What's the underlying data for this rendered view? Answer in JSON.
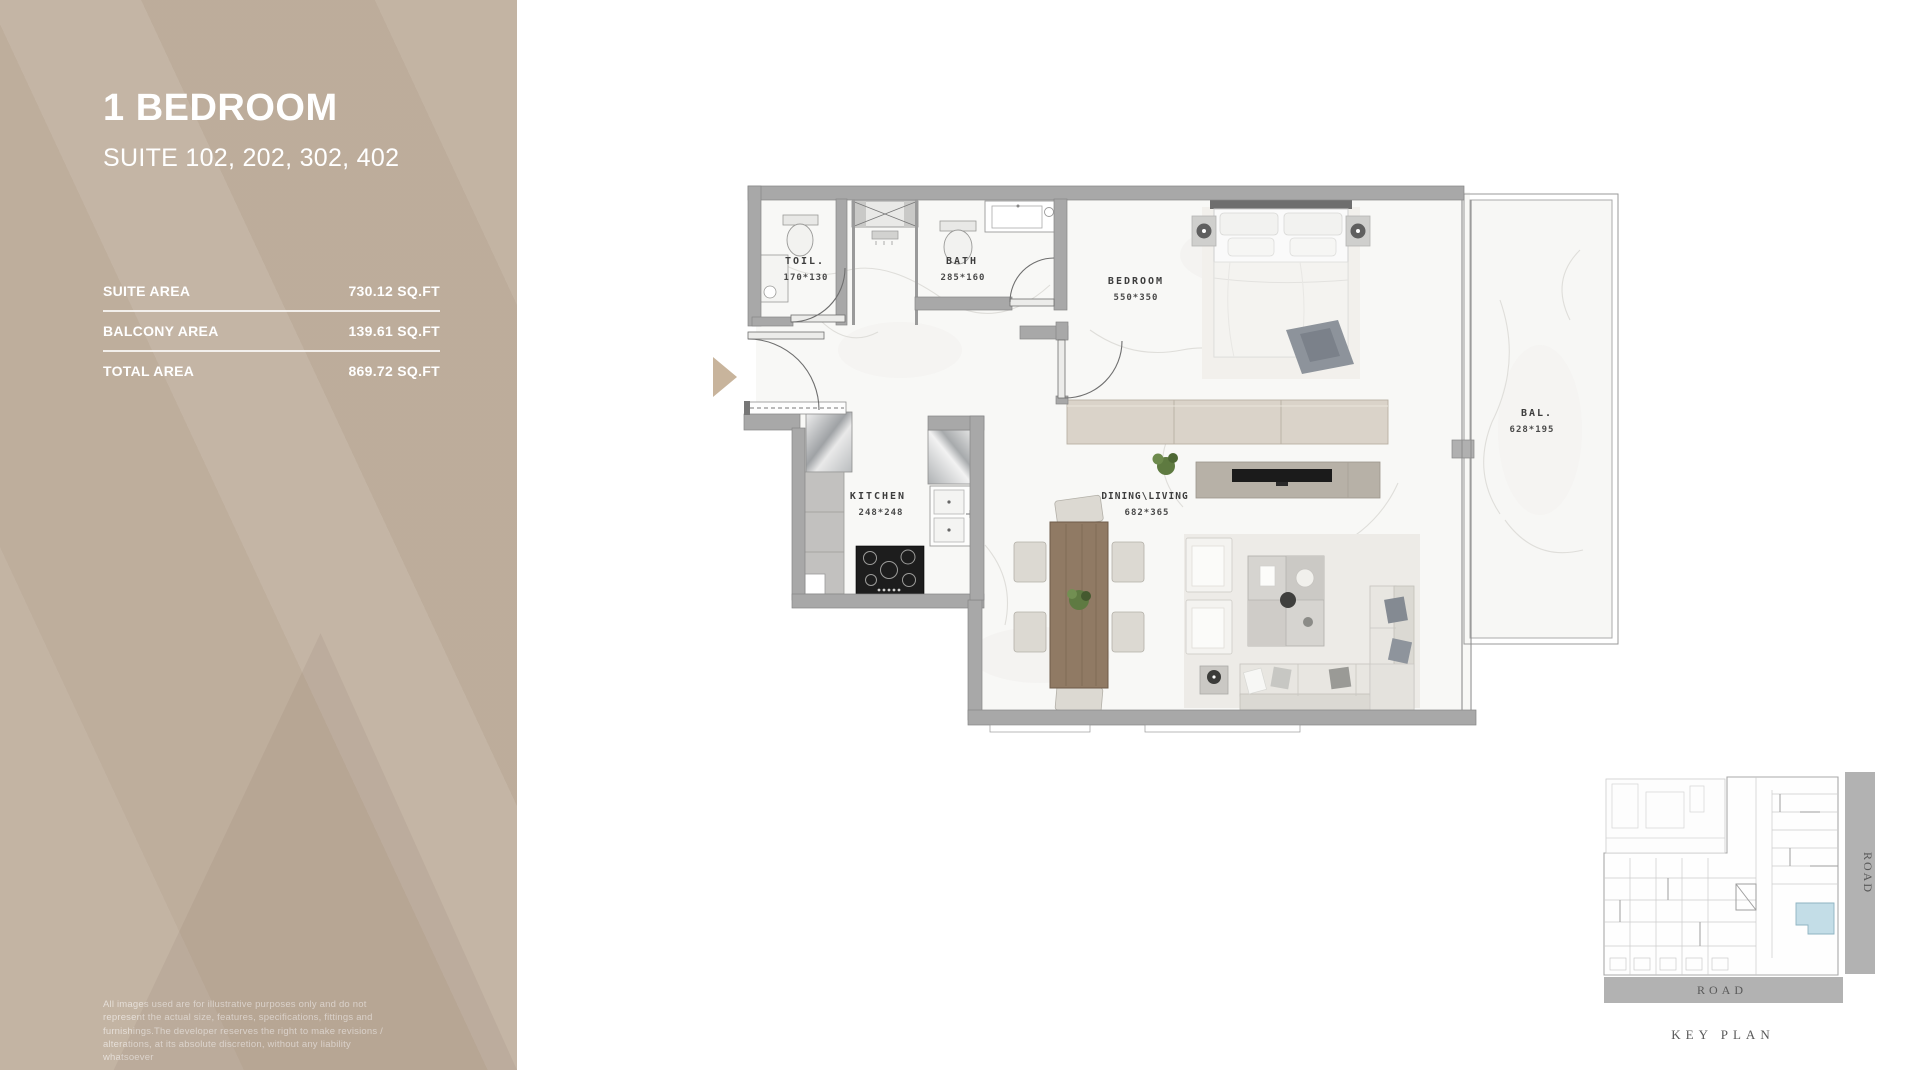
{
  "sidebar": {
    "title": "1 BEDROOM",
    "subtitle": "SUITE 102, 202, 302, 402",
    "areas": [
      {
        "label": "SUITE AREA",
        "value": "730.12 SQ.FT"
      },
      {
        "label": "BALCONY AREA",
        "value": "139.61 SQ.FT"
      },
      {
        "label": "TOTAL AREA",
        "value": "869.72 SQ.FT"
      }
    ],
    "disclaimer": "All images used are for illustrative purposes only and do not represent the actual size, features, specifications, fittings and furnishings.The developer reserves the right to make revisions / alterations, at its absolute discretion, without any liability whatsoever"
  },
  "floor_plan": {
    "rooms": [
      {
        "name": "TOIL.",
        "dims": "170*130"
      },
      {
        "name": "BATH",
        "dims": "285*160"
      },
      {
        "name": "BEDROOM",
        "dims": "550*350"
      },
      {
        "name": "KITCHEN",
        "dims": "248*248"
      },
      {
        "name": "DINING\\LIVING",
        "dims": "682*365"
      },
      {
        "name": "BAL.",
        "dims": "628*195"
      }
    ]
  },
  "key_plan": {
    "label": "KEY PLAN",
    "road_right": "ROAD",
    "road_bottom": "ROAD"
  },
  "colors": {
    "sidebar_bg": "#bcab99",
    "entry_arrow": "#c8b49c",
    "keyplan_highlight": "#c3dde7",
    "wall_gray": "#a8a8a8"
  }
}
